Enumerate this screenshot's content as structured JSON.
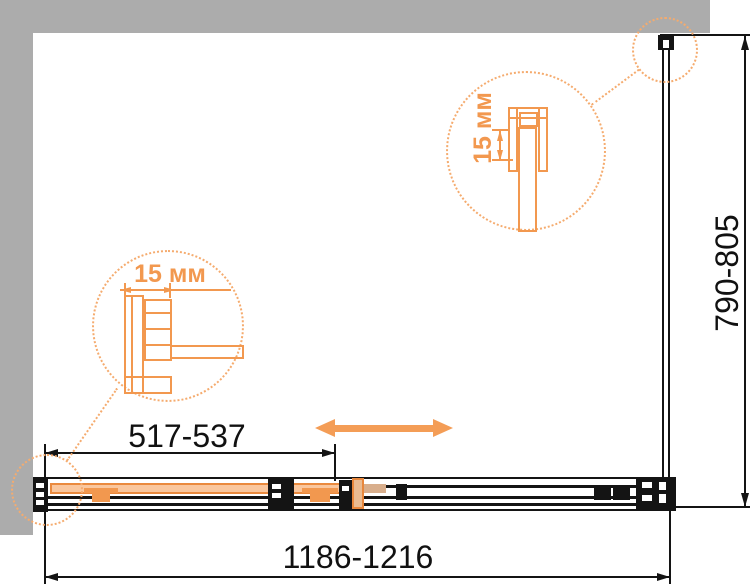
{
  "labels": {
    "overall_width": "1186-1216",
    "overall_height": "790-805",
    "fixed_panel_width": "517-537",
    "detail_left": "15 мм",
    "detail_top_right": "15 мм"
  },
  "colors": {
    "wall_gray": "#ACACAC",
    "line_black": "#141414",
    "detail_orange": "#F2984F",
    "glass_fill_orange": "#FAC79E",
    "dotted_circle_orange": "#F5AB6E",
    "roller_tan": "#D8AE8C"
  }
}
